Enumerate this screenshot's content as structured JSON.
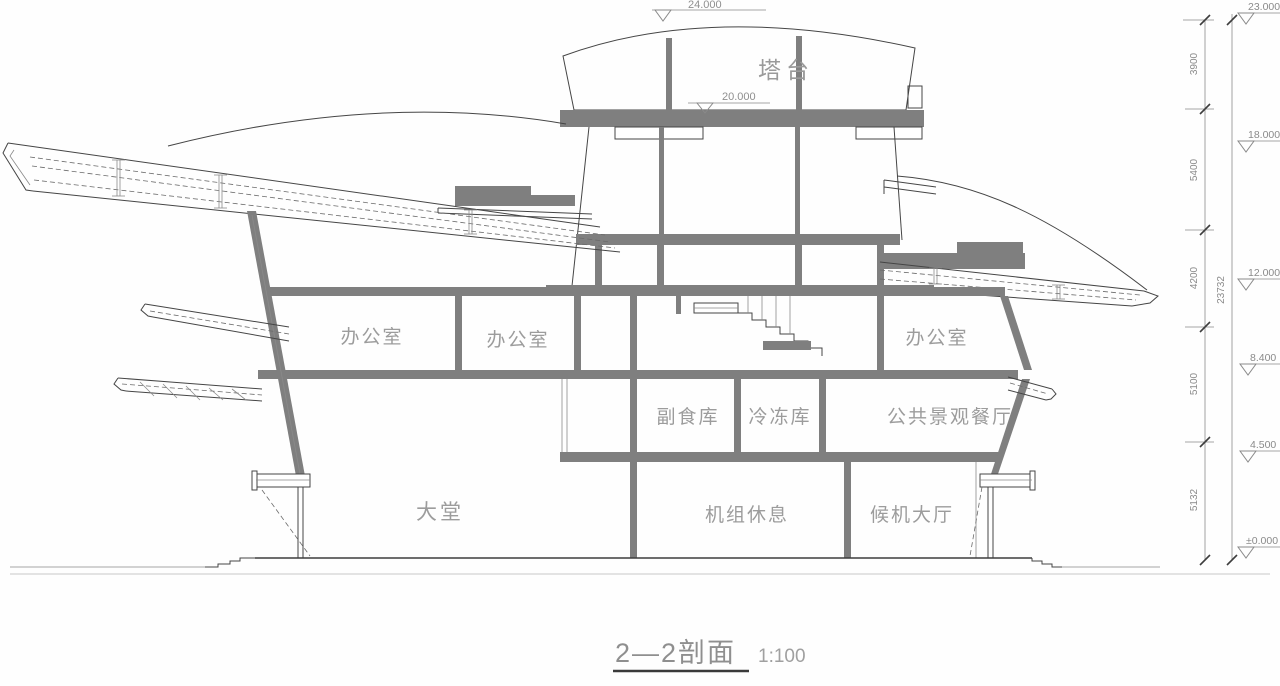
{
  "drawing": {
    "title": "2—2剖面",
    "scale": "1:100",
    "tower_label": "塔台",
    "rooms": {
      "office_left": "办公室",
      "office_mid": "办公室",
      "office_right": "办公室",
      "food_storage": "副食库",
      "cold_storage": "冷冻库",
      "restaurant": "公共景观餐厅",
      "lobby": "大堂",
      "crew_rest": "机组休息",
      "waiting_hall": "候机大厅"
    },
    "markers": {
      "roof_top": "24.000",
      "tower_floor": "20.000"
    },
    "elevations": {
      "right": [
        "23.000",
        "18.000",
        "12.000",
        "8.400",
        "4.500",
        "±0.000"
      ]
    },
    "dimensions": {
      "segments": [
        "3900",
        "5400",
        "4200",
        "5100",
        "5132"
      ],
      "total": "23732"
    },
    "colors": {
      "line": "#454545",
      "section_fill": "#7f7f7f",
      "label_gray": "#9c9c9c",
      "background": "#fefefe"
    }
  }
}
